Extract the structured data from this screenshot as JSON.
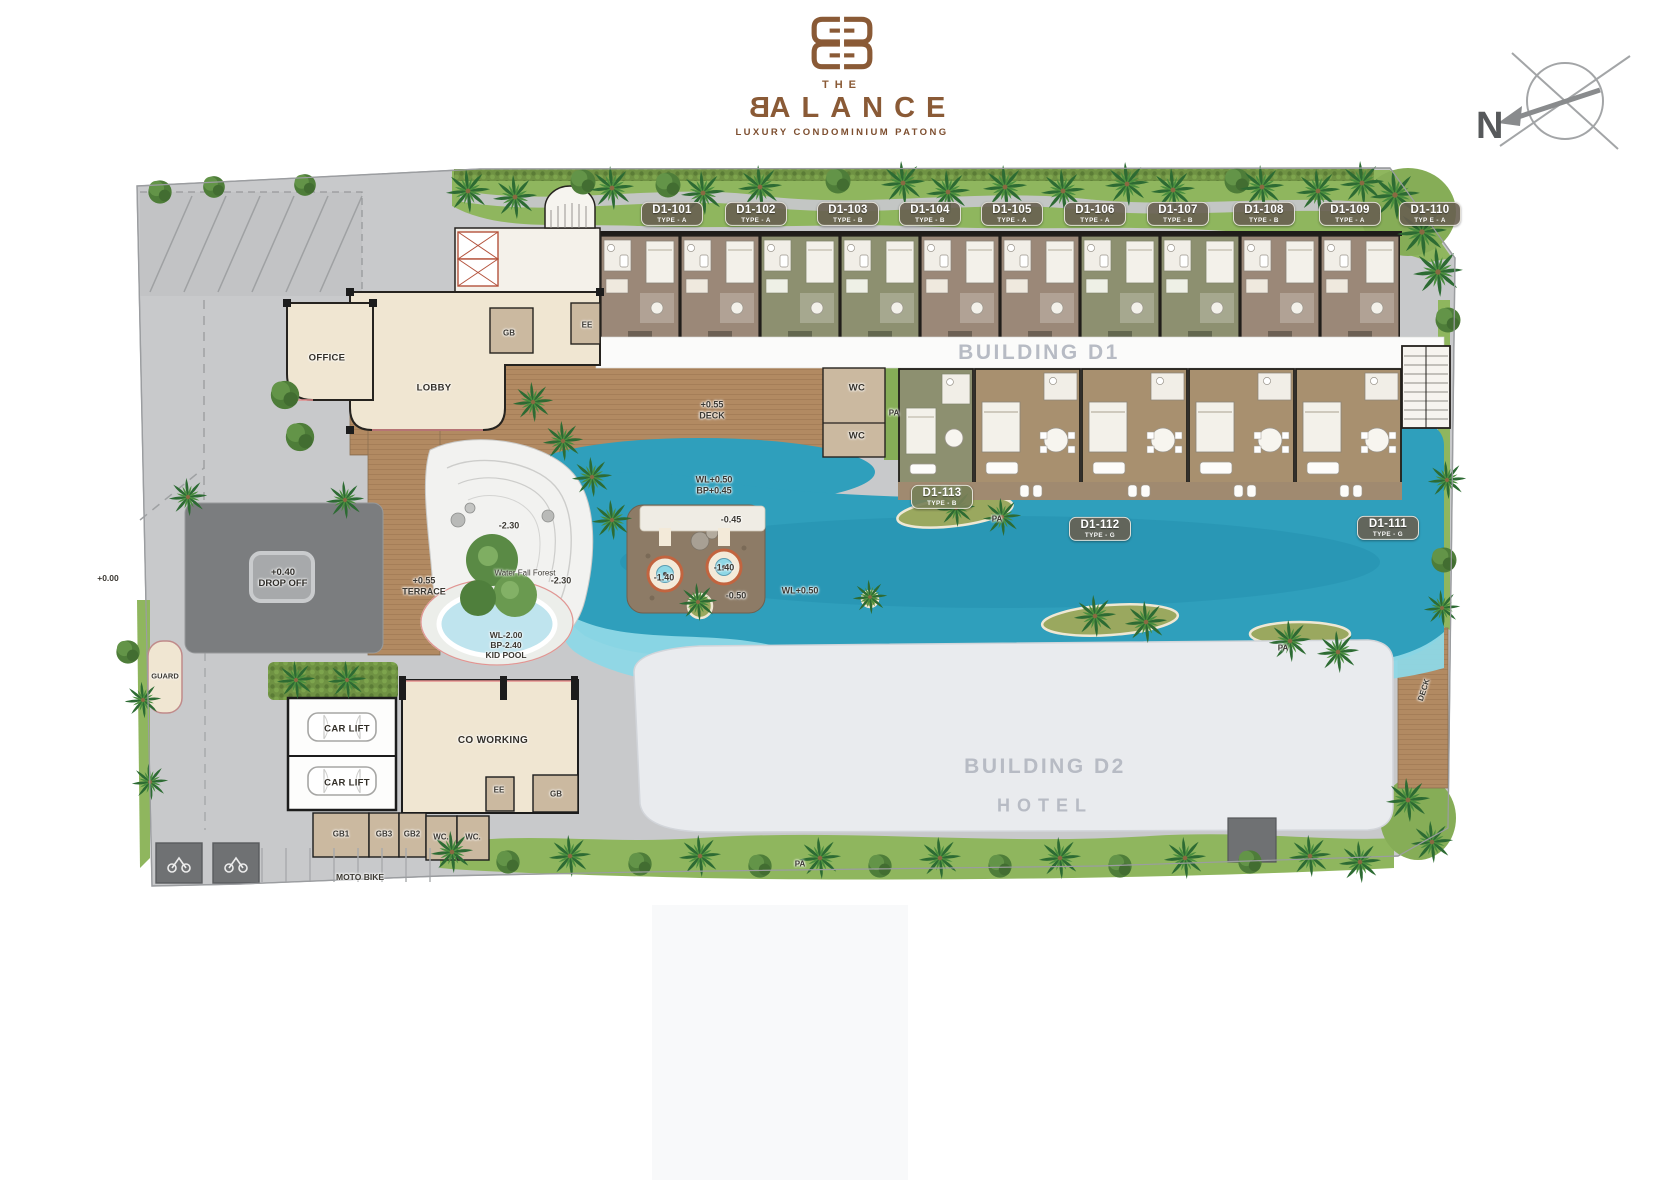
{
  "brand": {
    "the": "THE",
    "name_initial": "B",
    "name_rest": "ALANCE",
    "tagline": "LUXURY CONDOMINIUM PATONG"
  },
  "compass": {
    "north": "N"
  },
  "buildings": {
    "d1": "BUILDING D1",
    "d2": "BUILDING D2",
    "d2_sub": "HOTEL"
  },
  "units_top": [
    {
      "id": "D1-101",
      "type": "TYPE - A"
    },
    {
      "id": "D1-102",
      "type": "TYPE - A"
    },
    {
      "id": "D1-103",
      "type": "TYPE - B"
    },
    {
      "id": "D1-104",
      "type": "TYPE - B"
    },
    {
      "id": "D1-105",
      "type": "TYPE - A"
    },
    {
      "id": "D1-106",
      "type": "TYPE - A"
    },
    {
      "id": "D1-107",
      "type": "TYPE - B"
    },
    {
      "id": "D1-108",
      "type": "TYPE - B"
    },
    {
      "id": "D1-109",
      "type": "TYPE - A"
    },
    {
      "id": "D1-110",
      "type": "TYP E - A"
    }
  ],
  "units_pool": [
    {
      "id": "D1-113",
      "type": "TYPE - B"
    },
    {
      "id": "D1-112",
      "type": "TYPE - G"
    },
    {
      "id": "D1-111",
      "type": "TYPE - G"
    }
  ],
  "rooms": {
    "office": "OFFICE",
    "lobby": "LOBBY",
    "gb": "GB",
    "ee": "EE",
    "wc": "WC",
    "wc_dot": "WC.",
    "pa": "PA",
    "guard": "GUARD",
    "car_lift": "CAR LIFT",
    "co_working": "CO WORKING",
    "gb1": "GB1",
    "gb2": "GB2",
    "gb3": "GB3",
    "moto_bike": "MOTO BIKE",
    "deck": "DECK"
  },
  "levels": {
    "zero": "+0.00",
    "p040": "+0.40",
    "drop_off": "DROP OFF",
    "p055": "+0.55",
    "terrace": "TERRACE",
    "deck": "DECK",
    "wl_main": "WL+0.50",
    "bp_main": "BP+0.45",
    "m230": "-2.30",
    "m045": "-0.45",
    "m140": "-1.40",
    "m050": "-0.50",
    "kid_wl": "WL-2.00",
    "kid_bp": "BP-2.40",
    "kid_pool": "KID POOL",
    "waterfall": "Water Fall Forest"
  },
  "colors": {
    "brand": "#8a5a36",
    "pool": "#2f9fbc",
    "pool_shallow": "#8ed8e6",
    "green": "#8fb65e",
    "deck_wood": "#b28a62",
    "unit_a": "#9b8878",
    "unit_b": "#8d9070",
    "badge_bg": "#685f51",
    "badge_b_bg": "#778058",
    "building_text": "#b7bbc4"
  }
}
